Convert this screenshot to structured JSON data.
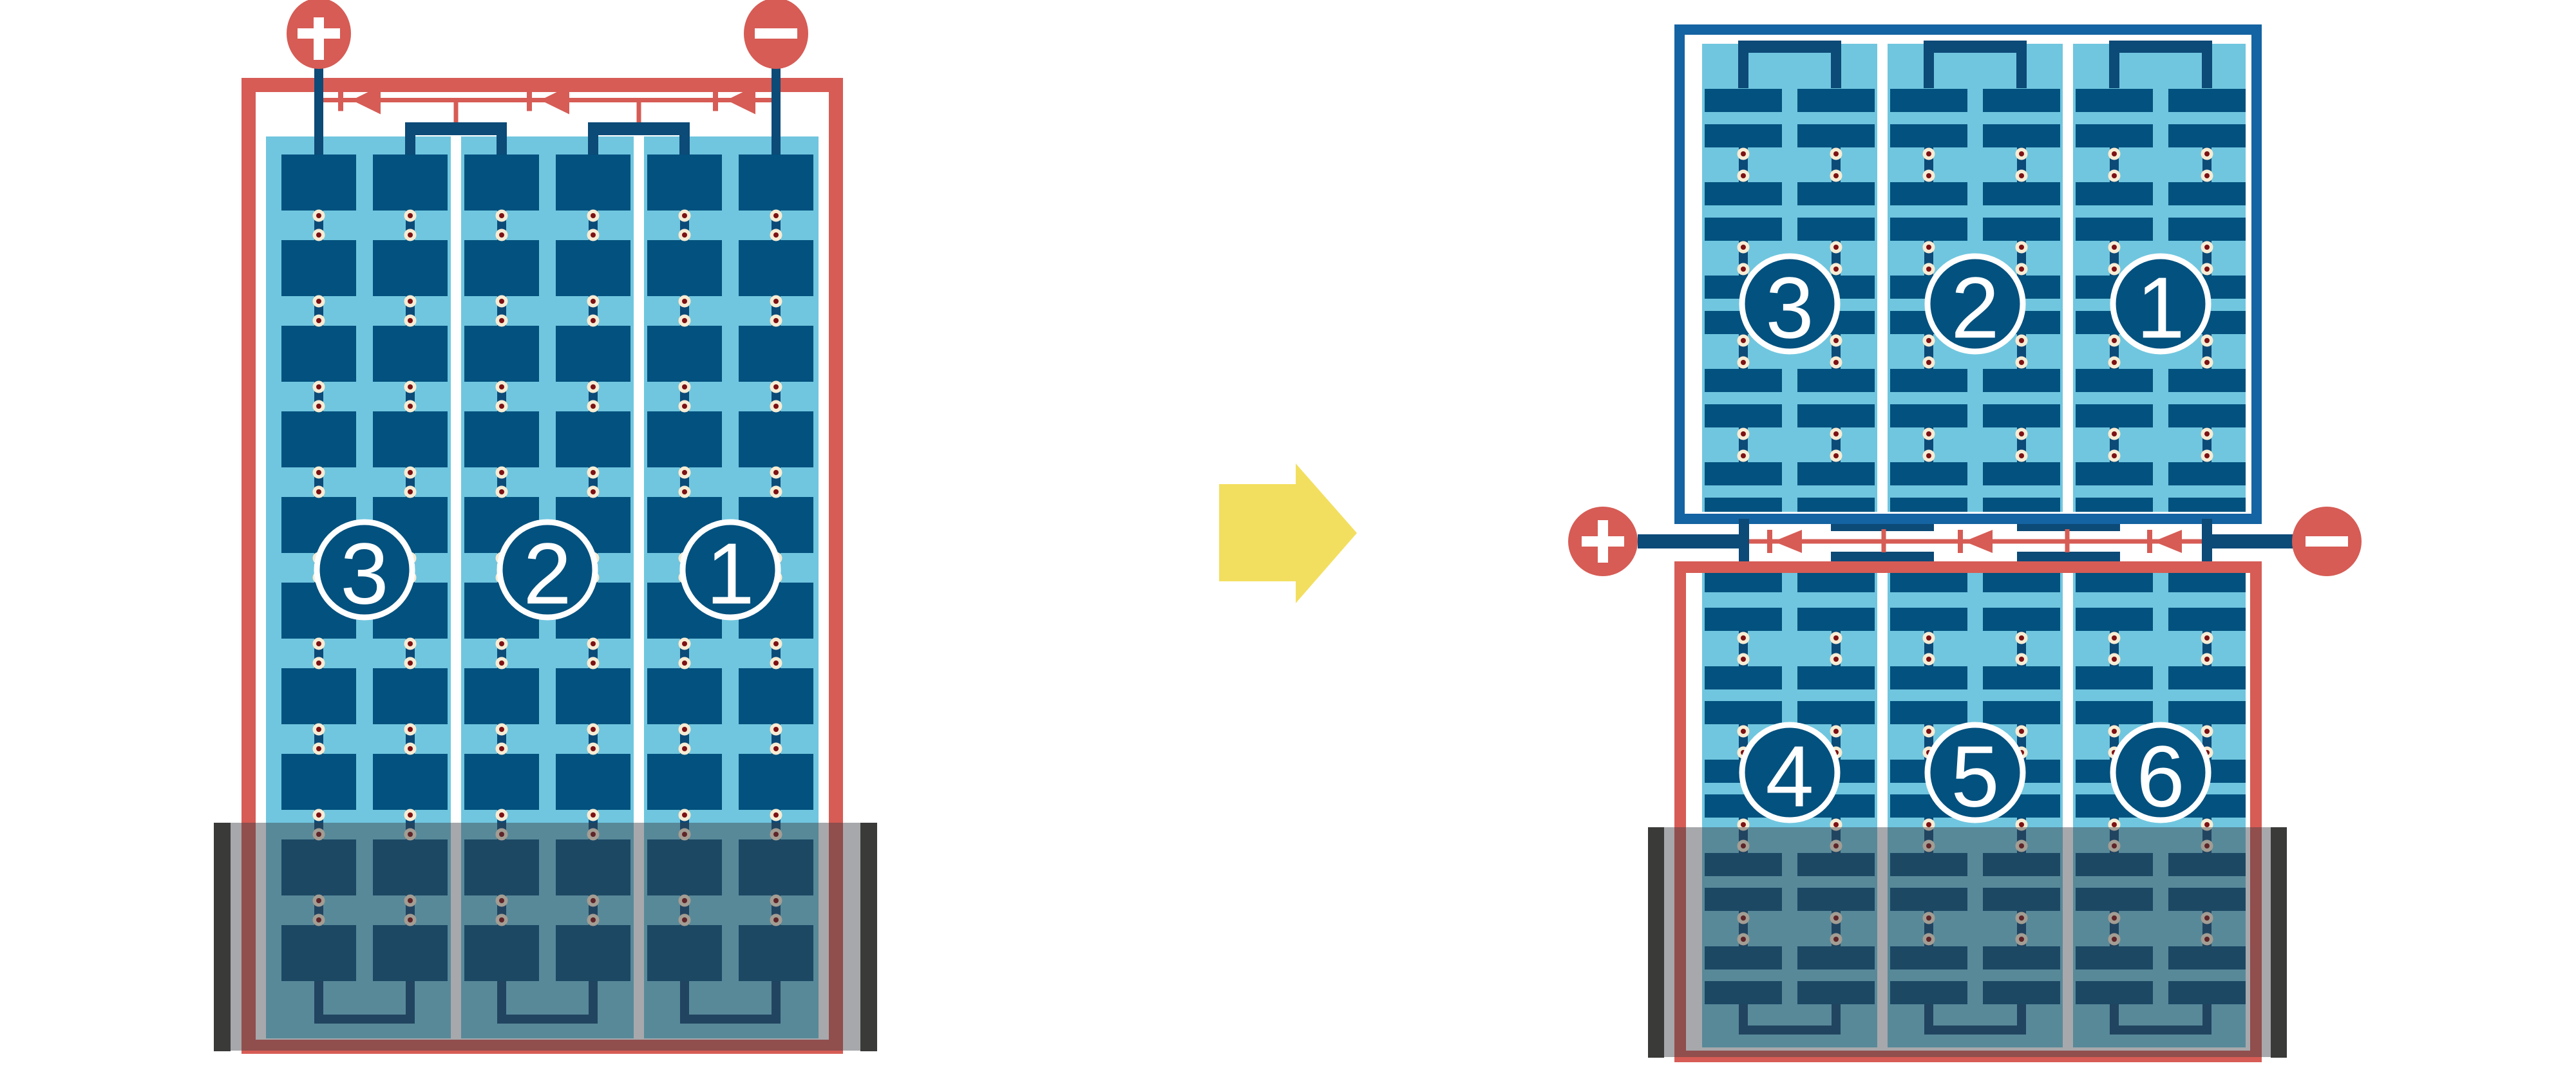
{
  "colors": {
    "background": "#FFFFFF",
    "wire_red": "#D65C55",
    "cell_navy": "#02517E",
    "connector_navy": "#0C4A77",
    "half_frame_blue": "#1463A2",
    "panel_light_blue": "#70C6DF",
    "string_gap_white": "#FFFFFF",
    "pad_cream": "#F7ECD4",
    "pad_dot_maroon": "#7D1113",
    "water_overlay": "rgba(60,62,68,0.45)",
    "tank_wall_gray": "#3A3A38",
    "arrow_yellow": "#F3DF5F",
    "badge_fill": "#02517E",
    "badge_ring": "#FFFFFF",
    "badge_text": "#FFFFFF"
  },
  "left_module": {
    "terminals": {
      "positive": "+",
      "negative": "−"
    },
    "string_badges": [
      "3",
      "2",
      "1"
    ],
    "bypass_diodes": 3,
    "cell_columns": 6,
    "cell_rows": 10
  },
  "right_module": {
    "terminals": {
      "positive": "+",
      "negative": "−"
    },
    "top_half": {
      "string_badges": [
        "3",
        "2",
        "1"
      ],
      "cell_columns": 6,
      "row_groups": 5
    },
    "bottom_half": {
      "string_badges": [
        "4",
        "5",
        "6"
      ],
      "cell_columns": 6,
      "row_groups": 5
    },
    "bypass_diodes": 3
  },
  "arrow_icon": {
    "direction": "right"
  }
}
